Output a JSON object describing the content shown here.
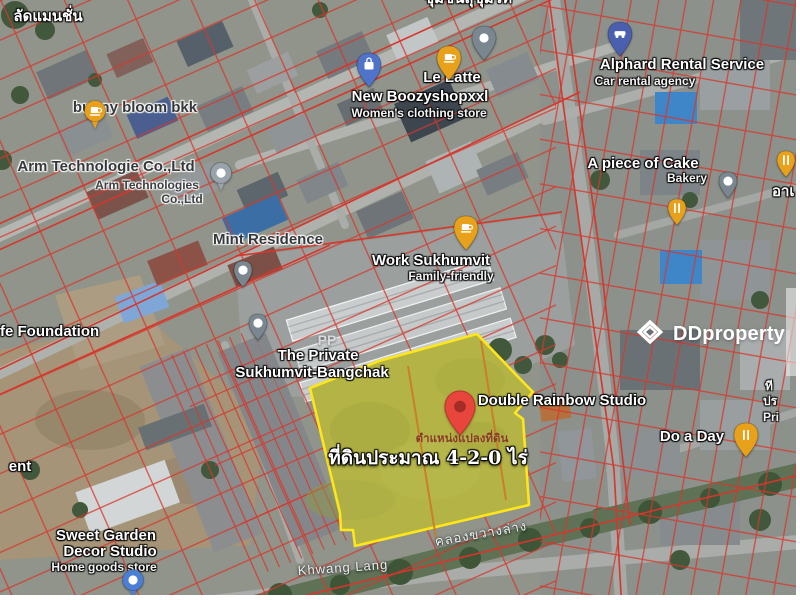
{
  "watermark": {
    "brand": "DDproperty",
    "logo_icon": "dd-chevron-logo"
  },
  "parcel": {
    "position_label": "ตำแหน่งแปลงที่ดิน",
    "area_label": "ที่ดินประมาณ 4-2-0 ไร่",
    "border_color": "#ffe619",
    "fill_color": "#9aa14b",
    "inner_line_color": "#cc7a26",
    "marker_color": "#e8453c"
  },
  "colors": {
    "cadastral_line": "#d6362b",
    "road": "#b0b3ae",
    "canal": "#5f7256",
    "pin_amber": "#e8a11b",
    "pin_gray": "#7b8790",
    "pin_blue": "#4e73c8",
    "pin_indigo": "#4a5fae",
    "pin_red": "#e8453c"
  },
  "map": {
    "labels": [
      {
        "name": "label-mansion",
        "text": "ลัดแมนชั่น",
        "cx": 48,
        "y": 9,
        "style": "white-lg"
      },
      {
        "name": "label-community-top",
        "text": "ชุมชนสุขุมวิท",
        "cx": 468,
        "y": -9,
        "style": "white-lg"
      },
      {
        "name": "label-bunny-bloom",
        "text": "bunny bloom bkk",
        "cx": 135,
        "y": 100,
        "style": "dark-lg"
      },
      {
        "name": "label-arm-line1",
        "text": "Arm Technologie Co.,Ltd",
        "cx": 106,
        "y": 159,
        "style": "dark-lg"
      },
      {
        "name": "label-arm-line2",
        "text": "Arm Technologies",
        "cx": 147,
        "y": 179,
        "style": "dark-sm"
      },
      {
        "name": "label-arm-line3",
        "text": "Co.,Ltd",
        "cx": 182,
        "y": 193,
        "style": "dark-sm"
      },
      {
        "name": "label-mint-residence",
        "text": "Mint Residence",
        "cx": 268,
        "y": 232,
        "style": "dark-lg"
      },
      {
        "name": "label-le-latte",
        "text": "Le Latte",
        "cx": 452,
        "y": 70,
        "style": "white-lg"
      },
      {
        "name": "label-boozyshop",
        "text": "New Boozyshopxxl",
        "cx": 420,
        "y": 89,
        "style": "white-lg"
      },
      {
        "name": "label-boozyshop-sub",
        "text": "Women's clothing store",
        "cx": 419,
        "y": 107,
        "style": "white-sm"
      },
      {
        "name": "label-alphard",
        "text": "Alphard Rental Service",
        "cx": 682,
        "y": 57,
        "style": "white-lg"
      },
      {
        "name": "label-alphard-sub",
        "text": "Car rental agency",
        "cx": 645,
        "y": 75,
        "style": "white-sm"
      },
      {
        "name": "label-piece-of-cake",
        "text": "A piece of Cake",
        "cx": 643,
        "y": 156,
        "style": "white-lg"
      },
      {
        "name": "label-bakery-sub",
        "text": "Bakery",
        "cx": 687,
        "y": 172,
        "style": "white-sm"
      },
      {
        "name": "label-right-thai",
        "text": "อาเ",
        "x": 772,
        "y": 184,
        "style": "white-lg"
      },
      {
        "name": "label-work-sukhumvit",
        "text": "Work Sukhumvit",
        "cx": 431,
        "y": 253,
        "style": "white-lg"
      },
      {
        "name": "label-work-sub",
        "text": "Family-friendly",
        "cx": 451,
        "y": 270,
        "style": "white-sm"
      },
      {
        "name": "label-foundation",
        "text": "fe Foundation",
        "x": 0,
        "y": 324,
        "style": "white-lg"
      },
      {
        "name": "label-private-line1",
        "text": "The Private",
        "cx": 318,
        "y": 348,
        "style": "white-lg"
      },
      {
        "name": "label-private-line2",
        "text": "Sukhumvit-Bangchak",
        "cx": 312,
        "y": 365,
        "style": "white-lg"
      },
      {
        "name": "label-pp",
        "text": "PP",
        "cx": 327,
        "y": 333,
        "style": "gray-md"
      },
      {
        "name": "label-double-rainbow",
        "text": "Double Rainbow Studio",
        "cx": 562,
        "y": 393,
        "style": "white-lg"
      },
      {
        "name": "label-do-a-day",
        "text": "Do a Day",
        "cx": 692,
        "y": 429,
        "style": "white-lg"
      },
      {
        "name": "label-parcel-position",
        "text": "ตำแหน่งแปลงที่ดิน",
        "cx": 462,
        "y": 432,
        "style": "pos"
      },
      {
        "name": "label-parcel-area",
        "text": "ที่ดินประมาณ 4-2-0 ไร่",
        "cx": 428,
        "y": 449,
        "style": "area"
      },
      {
        "name": "label-sweet-line1",
        "text": "Sweet Garden",
        "cx": 106,
        "y": 528,
        "style": "white-lg"
      },
      {
        "name": "label-sweet-line2",
        "text": "Decor Studio",
        "cx": 110,
        "y": 544,
        "style": "white-lg"
      },
      {
        "name": "label-sweet-sub",
        "text": "Home goods store",
        "cx": 104,
        "y": 561,
        "style": "white-sm"
      },
      {
        "name": "label-ent-partial",
        "text": "ent",
        "cx": 20,
        "y": 459,
        "style": "white-lg"
      },
      {
        "name": "label-khwang-lang",
        "text": "Khwang Lang",
        "cx": 343,
        "y": 561,
        "style": "road",
        "rotate": -4
      },
      {
        "name": "label-canal",
        "text": "คลองขวางล่าง",
        "cx": 481,
        "y": 527,
        "style": "road",
        "rotate": -10
      },
      {
        "name": "label-right-partial-1",
        "text": "ที",
        "x": 765,
        "y": 380,
        "style": "white-sm"
      },
      {
        "name": "label-right-partial-2",
        "text": "ปร",
        "x": 763,
        "y": 395,
        "style": "white-sm"
      },
      {
        "name": "label-right-partial-3",
        "text": "Pri",
        "x": 763,
        "y": 411,
        "style": "white-sm"
      }
    ],
    "pins": [
      {
        "name": "pin-bunny-bloom-cafe",
        "style": "circle",
        "color": "#e8a11b",
        "icon": "cafe",
        "x": 95,
        "y": 131
      },
      {
        "name": "pin-le-latte-cafe",
        "style": "teardrop-lg",
        "color": "#e8a11b",
        "icon": "cafe",
        "x": 449,
        "y": 81
      },
      {
        "name": "pin-place-top",
        "style": "teardrop-lg",
        "color": "#7b8790",
        "icon": "dot",
        "x": 484,
        "y": 61
      },
      {
        "name": "pin-boozyshop-shopping",
        "style": "teardrop-lg",
        "color": "#4e73c8",
        "icon": "shopping",
        "x": 369,
        "y": 88
      },
      {
        "name": "pin-alphard-car",
        "style": "teardrop-lg",
        "color": "#4a5fae",
        "icon": "car",
        "x": 620,
        "y": 57
      },
      {
        "name": "pin-arm-tech",
        "style": "circle",
        "color": "#99a3ab",
        "icon": "dot",
        "x": 221,
        "y": 193
      },
      {
        "name": "pin-mint-residence",
        "style": "teardrop",
        "color": "#7b8790",
        "icon": "dot",
        "x": 243,
        "y": 288
      },
      {
        "name": "pin-the-private",
        "style": "teardrop",
        "color": "#7b8790",
        "icon": "dot",
        "x": 258,
        "y": 341
      },
      {
        "name": "pin-work-sukhumvit-cafe",
        "style": "teardrop-lg",
        "color": "#e8a11b",
        "icon": "cafe",
        "x": 466,
        "y": 251
      },
      {
        "name": "pin-cake-place",
        "style": "teardrop",
        "color": "#7b8790",
        "icon": "dot",
        "x": 728,
        "y": 199
      },
      {
        "name": "pin-cake-restaurant",
        "style": "teardrop",
        "color": "#e8a11b",
        "icon": "restaurant",
        "x": 677,
        "y": 226
      },
      {
        "name": "pin-right-edge-restaurant",
        "style": "teardrop",
        "color": "#e8a11b",
        "icon": "restaurant",
        "x": 786,
        "y": 178
      },
      {
        "name": "pin-do-a-day-restaurant",
        "style": "teardrop-lg",
        "color": "#e8a11b",
        "icon": "restaurant",
        "x": 746,
        "y": 458
      },
      {
        "name": "pin-land-marker",
        "style": "marker",
        "color": "#e8453c",
        "icon": "hole",
        "x": 460,
        "y": 436
      },
      {
        "name": "pin-bottom-transit",
        "style": "circle",
        "color": "#4a7fd4",
        "icon": "dot",
        "x": 133,
        "y": 600
      }
    ]
  }
}
